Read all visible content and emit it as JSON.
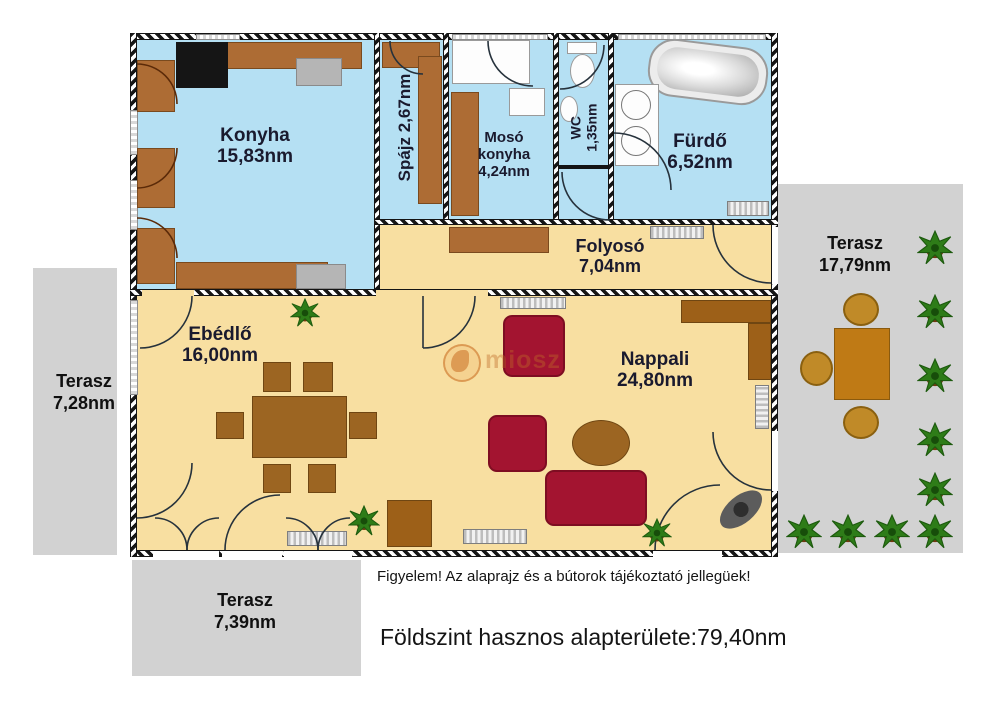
{
  "rooms": {
    "konyha": {
      "name": "Konyha",
      "area": "15,83nm"
    },
    "spajz": {
      "name": "Spájz",
      "area": "2,67nm"
    },
    "moso": {
      "name": "Mosó konyha",
      "area": "4,24nm"
    },
    "wc": {
      "name": "WC",
      "area": "1,35nm"
    },
    "furdo": {
      "name": "Fürdő",
      "area": "6,52nm"
    },
    "folyoso": {
      "name": "Folyosó",
      "area": "7,04nm"
    },
    "ebedlo": {
      "name": "Ebédlő",
      "area": "16,00nm"
    },
    "nappali": {
      "name": "Nappali",
      "area": "24,80nm"
    }
  },
  "terraces": {
    "right": {
      "name": "Terasz",
      "area": "17,79nm"
    },
    "left": {
      "name": "Terasz",
      "area": "7,28nm"
    },
    "bottom": {
      "name": "Terasz",
      "area": "7,39nm"
    }
  },
  "footer": {
    "disclaimer": "Figyelem! Az alaprajz és a bútorok tájékoztató jellegüek!",
    "total_area": "Földszint hasznos alapterülete:79,40nm"
  },
  "watermark": {
    "text": "miosz"
  },
  "colors": {
    "floor_wet": "#b5e0f3",
    "floor_living": "#f8dfa1",
    "terrace": "#d2d2d2",
    "furniture_brown": "#ad6c34",
    "sofa_red": "#a31430",
    "wall": "#141414"
  }
}
